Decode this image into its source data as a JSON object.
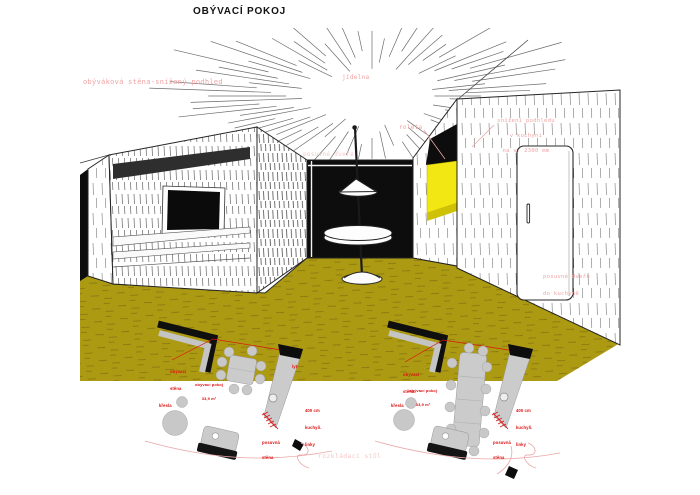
{
  "title": "OBÝVACÍ POKOJ",
  "colors": {
    "floor_olive": "#ac9a12",
    "accent_yellow": "#f2e713",
    "annotation_pink": "#f0a3a3",
    "annotation_pink_faint": "#f7c9c9",
    "label_red": "#dd1111"
  },
  "perspective": {
    "wall_note": "obýváková stěna-snížený podhled",
    "dining_label": "jídelna",
    "blind_label": "roleta",
    "ceiling_note": [
      "snížení podhledu",
      "v kuchyni",
      "na v. 2300 mm"
    ],
    "sliding_door_label": "posuvné dveře",
    "kitchen_door_note": [
      "posuvné dveře",
      "do kuchyně"
    ],
    "folding_table_label": "rozkládací stůl"
  },
  "floor_plans": {
    "left": {
      "wall_label": [
        "obývací",
        "stěna"
      ],
      "room_label": [
        "obývací pokoj",
        "33,9 m²"
      ],
      "armchairs_label": "křesla",
      "corner_label": "lyt",
      "kitchen_label": [
        "400 cm",
        "kuchyň.",
        "linky"
      ],
      "partition_label": [
        "posuvná",
        "stěna"
      ]
    },
    "right": {
      "wall_label": [
        "obývací",
        "stěna"
      ],
      "room_label": [
        "obývací pokoj",
        "33,9 m²"
      ],
      "armchairs_label": "křesla",
      "kitchen_label": [
        "400 cm",
        "kuchyň.",
        "linky"
      ],
      "partition_label": [
        "posuvná",
        "stěna"
      ]
    }
  }
}
